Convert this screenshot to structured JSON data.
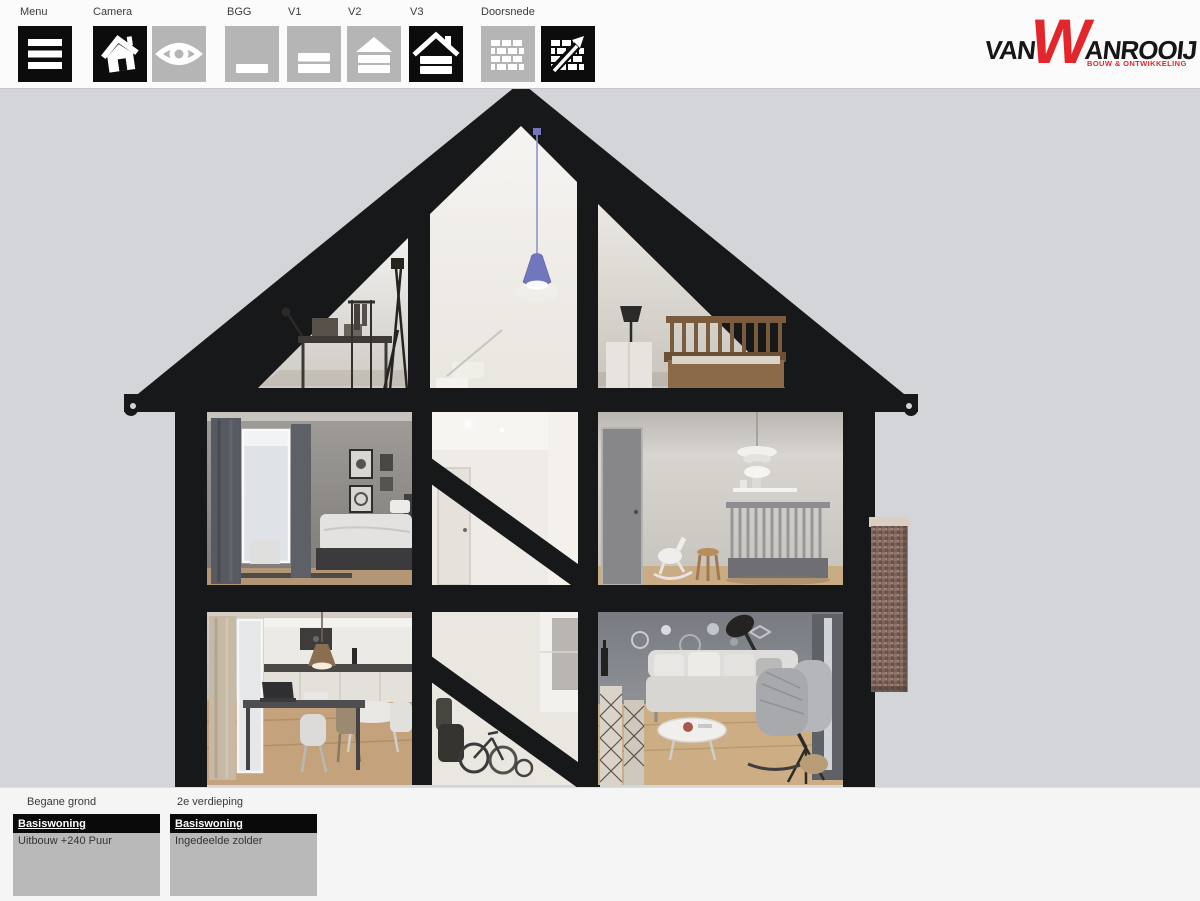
{
  "toolbar": {
    "menu": {
      "label": "Menu"
    },
    "camera": {
      "label": "Camera"
    },
    "floors": [
      {
        "label": "BGG",
        "selected": false
      },
      {
        "label": "V1",
        "selected": false
      },
      {
        "label": "V2",
        "selected": false
      },
      {
        "label": "V3",
        "selected": true
      }
    ],
    "section": {
      "label": "Doorsnede"
    }
  },
  "logo": {
    "van": "VAN",
    "w": "W",
    "anrooij": "ANROOIJ",
    "tagline": "BOUW & ONTWIKKELING",
    "accent": "#e3262c"
  },
  "panels": [
    {
      "label": "Begane grond",
      "options": [
        {
          "text": "Basiswoning",
          "selected": true
        },
        {
          "text": "Uitbouw +240 Puur",
          "selected": false
        }
      ]
    },
    {
      "label": "2e verdieping",
      "options": [
        {
          "text": "Basiswoning",
          "selected": true
        },
        {
          "text": "Ingedeelde zolder",
          "selected": false
        }
      ]
    }
  ],
  "colors": {
    "accent_red": "#e3262c",
    "selected_button": "#0c0c0c",
    "unselected_button": "#b5b5b5",
    "background": "#d4d5d8",
    "toolbar_bg": "#fbfbfb",
    "footer_bg": "#f5f5f6",
    "panel_body": "#b9b9b9",
    "structure_black": "#17181a"
  },
  "icons": [
    "hamburger-icon",
    "house-icon",
    "eye-icon",
    "floor-bgg-icon",
    "floor-v1-icon",
    "floor-v2-icon",
    "floor-v3-icon",
    "bricks-icon",
    "bricks-cut-arrow-icon"
  ]
}
